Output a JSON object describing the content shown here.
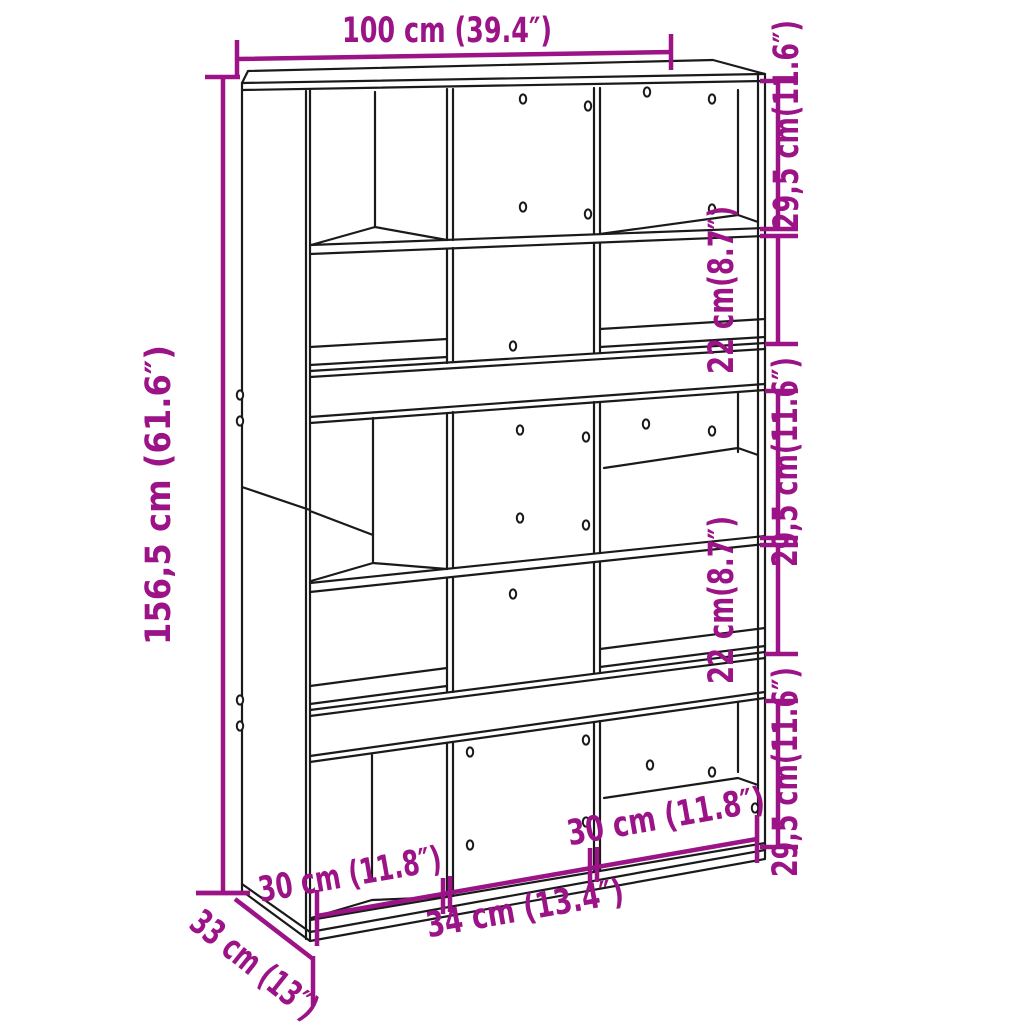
{
  "diagram": {
    "type": "furniture-dimension-drawing",
    "subject": "room-divider bookcase with cube shelves",
    "colors": {
      "dimension_annotations": "#9B1386",
      "drawing_lines": "#1a1a1a",
      "background": "#ffffff"
    },
    "dimensions": {
      "width": {
        "label": "100 cm (39.4″)"
      },
      "height": {
        "label": "156,5 cm (61.6″)"
      },
      "depth": {
        "label": "33 cm (13″)"
      },
      "right_sections": [
        {
          "label": "29,5 cm(11.6″)"
        },
        {
          "label": "22 cm(8.7″)"
        },
        {
          "label": "29,5 cm(11.6″)"
        },
        {
          "label": "22 cm(8.7″)"
        },
        {
          "label": "29,5 cm(11.6″)"
        }
      ],
      "bottom_sections": [
        {
          "label": "30 cm (11.8″)"
        },
        {
          "label": "34 cm (13.4″)"
        },
        {
          "label": "30 cm (11.8″)"
        }
      ]
    }
  }
}
